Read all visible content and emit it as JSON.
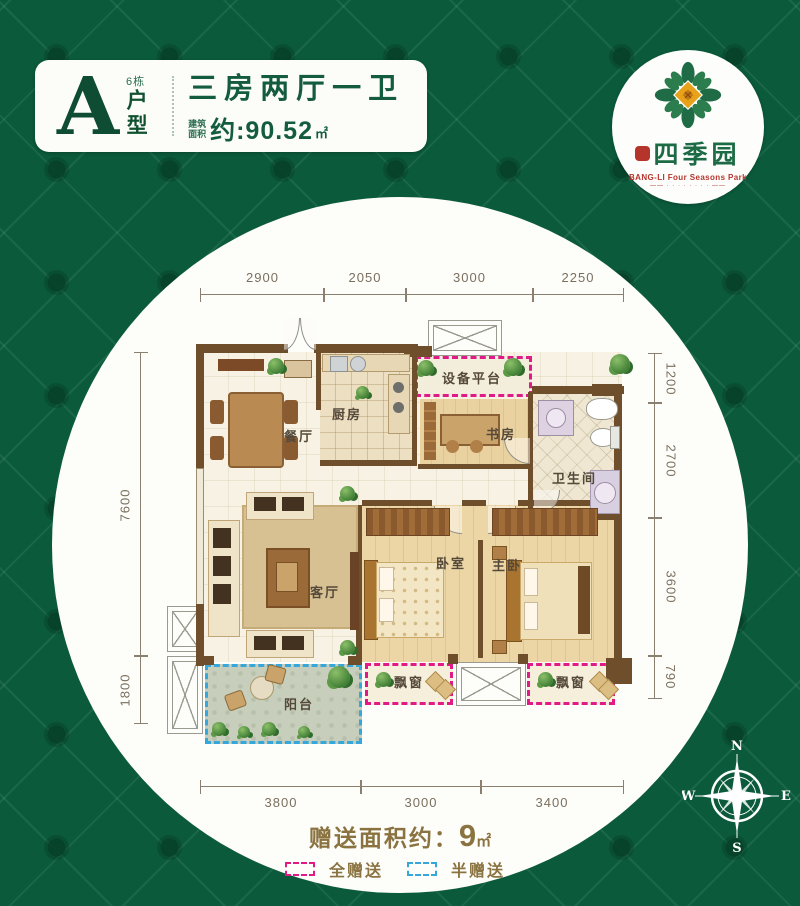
{
  "header": {
    "letter": "A",
    "building": "6栋",
    "unit": "户型",
    "title": "三房两厅一卫",
    "area_l1": "建筑",
    "area_l2": "面积",
    "area_value": "约:90.52",
    "area_unit": "㎡"
  },
  "logo": {
    "name": "四季园",
    "english": "BANG-LI Four Seasons Park",
    "tagline": "—— · · · · · · · · ——"
  },
  "plan": {
    "rooms": {
      "dining": "餐厅",
      "kitchen": "厨房",
      "equipment": "设备平台",
      "study": "书房",
      "bath": "卫生间",
      "living": "客厅",
      "bedroom": "卧室",
      "master": "主卧",
      "balcony": "阳台",
      "bay1": "飘窗",
      "bay2": "飘窗"
    },
    "dims": {
      "top": [
        {
          "v": "2900"
        },
        {
          "v": "2050"
        },
        {
          "v": "3000"
        },
        {
          "v": "2250"
        }
      ],
      "bottom": [
        {
          "v": "3800"
        },
        {
          "v": "3000"
        },
        {
          "v": "3400"
        }
      ],
      "left": [
        {
          "v": "7600"
        },
        {
          "v": "1800"
        }
      ],
      "right": [
        {
          "v": "1200"
        },
        {
          "v": "2700"
        },
        {
          "v": "3600"
        },
        {
          "v": "790"
        }
      ]
    }
  },
  "footer": {
    "gift_label": "赠送面积约：",
    "gift_value": "9",
    "gift_unit": "㎡",
    "legend": [
      {
        "label": "全赠送",
        "color": "#e01a86"
      },
      {
        "label": "半赠送",
        "color": "#35a7da"
      }
    ]
  },
  "compass": {
    "n": "N",
    "s": "S",
    "e": "E",
    "w": "W"
  },
  "colors": {
    "background_green": "#0b5a3c",
    "brand_green": "#1d6b45",
    "brand_red": "#b5342c",
    "header_text": "#145c3e",
    "gift_text": "#8a7340",
    "full_gift_dash": "#e01a86",
    "half_gift_dash": "#35a7da",
    "wall_brown": "#6f4e2c"
  }
}
